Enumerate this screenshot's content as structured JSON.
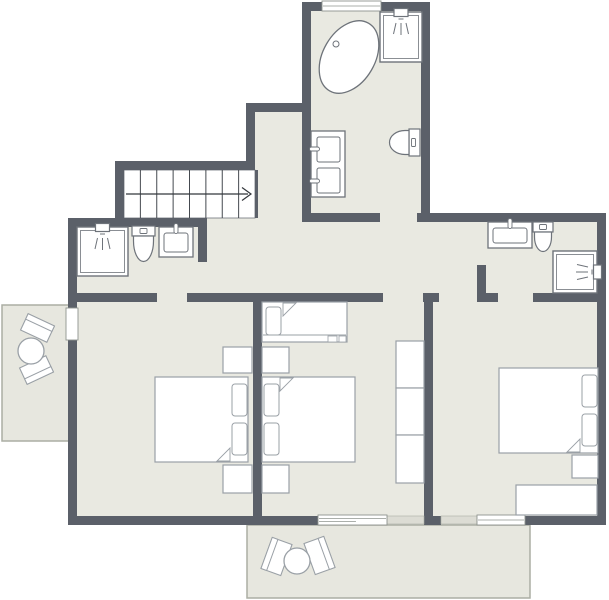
{
  "meta": {
    "description": "Architectural floor plan of an upper storey: three bedrooms, three bathrooms, staircase with up-arrow, two balconies with round tables and chairs. No text labels are rendered in the image."
  },
  "canvas": {
    "width": 609,
    "height": 600
  },
  "colors": {
    "wall": "#5b6069",
    "wall_light": "#dcdcd4",
    "floor": "#e9e9e1",
    "stairs_floor": "#ffffff",
    "balcony_floor": "#e7e7df",
    "balcony_border": "#abaea4",
    "fixture_stroke": "#6e737a",
    "furniture_stroke": "#9aa0a6",
    "opening_stroke": "#8f948f",
    "stair_line": "#44494f",
    "arrow": "#33373c",
    "white": "#ffffff"
  },
  "floorplan": {
    "floors": [
      {
        "name": "floor-top-bathroom",
        "rect": [
          306,
          8,
          120,
          210
        ]
      },
      {
        "name": "floor-upper-hall",
        "rect": [
          250,
          107,
          56,
          115
        ]
      },
      {
        "name": "floor-main-level",
        "rect": [
          72,
          218,
          530,
          303
        ]
      }
    ],
    "balconies": [
      {
        "name": "balcony-left",
        "rect": [
          2,
          305,
          70,
          136
        ]
      },
      {
        "name": "balcony-bottom",
        "rect": [
          247,
          525,
          283,
          73
        ]
      }
    ],
    "stairs": {
      "name": "staircase",
      "rect": [
        124,
        170,
        131,
        48
      ],
      "steps": 8,
      "rail_y": 194,
      "arrow": "right"
    },
    "walls": [
      {
        "name": "wall-topbath-left",
        "r": [
          302,
          2,
          9,
          220
        ]
      },
      {
        "name": "wall-topbath-top-a",
        "r": [
          302,
          2,
          20,
          9
        ]
      },
      {
        "name": "wall-topbath-top-b",
        "r": [
          381,
          2,
          49,
          9
        ]
      },
      {
        "name": "wall-topbath-right",
        "r": [
          421,
          2,
          9,
          220
        ]
      },
      {
        "name": "wall-step-horizontal",
        "r": [
          246,
          103,
          65,
          9
        ]
      },
      {
        "name": "wall-step-vertical",
        "r": [
          246,
          103,
          9,
          67
        ]
      },
      {
        "name": "wall-stairs-top",
        "r": [
          115,
          161,
          140,
          9
        ]
      },
      {
        "name": "wall-stairs-left",
        "r": [
          115,
          161,
          9,
          66
        ]
      },
      {
        "name": "wall-west-top",
        "r": [
          68,
          218,
          139,
          9
        ]
      },
      {
        "name": "wall-west-upper",
        "r": [
          68,
          218,
          9,
          90
        ]
      },
      {
        "name": "wall-west-lower",
        "r": [
          68,
          340,
          9,
          185
        ]
      },
      {
        "name": "wall-topbath-bottom-a",
        "r": [
          302,
          213,
          78,
          9
        ]
      },
      {
        "name": "wall-topbath-bottom-b",
        "r": [
          417,
          213,
          13,
          9
        ]
      },
      {
        "name": "wall-north-right",
        "r": [
          430,
          213,
          176,
          9
        ]
      },
      {
        "name": "wall-east",
        "r": [
          597,
          213,
          9,
          312
        ]
      },
      {
        "name": "wall-rightbath-left",
        "r": [
          477,
          265,
          9,
          37
        ]
      },
      {
        "name": "wall-rightbath-bottom-a",
        "r": [
          477,
          293,
          21,
          9
        ]
      },
      {
        "name": "wall-rightbath-bottom-b",
        "r": [
          533,
          293,
          64,
          9
        ]
      },
      {
        "name": "wall-mid-a",
        "r": [
          68,
          293,
          89,
          9
        ]
      },
      {
        "name": "wall-mid-b",
        "r": [
          187,
          293,
          196,
          9
        ]
      },
      {
        "name": "wall-mid-c",
        "r": [
          423,
          293,
          16,
          9
        ]
      },
      {
        "name": "wall-leftbath-right",
        "r": [
          198,
          218,
          9,
          44
        ]
      },
      {
        "name": "wall-bedroom1-2",
        "r": [
          253,
          302,
          9,
          214
        ]
      },
      {
        "name": "wall-bedroom2-3",
        "r": [
          424,
          302,
          9,
          214
        ]
      },
      {
        "name": "wall-south-a",
        "r": [
          68,
          516,
          250,
          9
        ]
      },
      {
        "name": "wall-south-b",
        "r": [
          424,
          516,
          17,
          9
        ]
      },
      {
        "name": "wall-south-c",
        "r": [
          525,
          516,
          81,
          9
        ]
      },
      {
        "name": "wall-stair-divider",
        "r": [
          255,
          170,
          3,
          48
        ]
      }
    ],
    "low_walls": [
      {
        "name": "low-wall-a",
        "r": [
          387,
          516,
          37,
          8
        ]
      },
      {
        "name": "low-wall-b",
        "r": [
          441,
          516,
          36,
          8
        ]
      }
    ],
    "openings": [
      {
        "name": "window-top",
        "style": "window",
        "rect": [
          322,
          1,
          59,
          10
        ]
      },
      {
        "name": "balcony-door-left",
        "style": "door",
        "rect": [
          66,
          308,
          12,
          32
        ]
      },
      {
        "name": "sliding-door-bottom",
        "style": "slider",
        "rect": [
          318,
          515,
          69,
          10
        ]
      },
      {
        "name": "window-bottom",
        "style": "window",
        "rect": [
          477,
          515,
          48,
          10
        ]
      }
    ],
    "fixtures": [
      {
        "type": "bathtub",
        "name": "bathtub",
        "cx": 349,
        "cy": 57,
        "rx": 39,
        "ry": 26,
        "rot": -60,
        "drain": [
          336,
          44
        ]
      },
      {
        "type": "shower",
        "name": "shower-top-bathroom",
        "rect": [
          380,
          12,
          42,
          50
        ],
        "head": "top"
      },
      {
        "type": "vanity2",
        "name": "double-sink-vanity",
        "rect": [
          311,
          131,
          34,
          66
        ]
      },
      {
        "type": "toilet",
        "name": "toilet-top-bathroom",
        "dir": "left",
        "rect": [
          388,
          129,
          32,
          27
        ]
      },
      {
        "type": "shower",
        "name": "shower-left-bathroom",
        "rect": [
          77,
          227,
          51,
          49
        ],
        "head": "top"
      },
      {
        "type": "toilet",
        "name": "toilet-left-bathroom",
        "dir": "down",
        "rect": [
          132,
          226,
          23,
          37
        ]
      },
      {
        "type": "sink",
        "name": "sink-left-bathroom",
        "rect": [
          159,
          227,
          34,
          30
        ]
      },
      {
        "type": "sink",
        "name": "sink-right-bathroom",
        "rect": [
          488,
          222,
          44,
          26
        ]
      },
      {
        "type": "toilet",
        "name": "toilet-right-bathroom",
        "dir": "down",
        "rect": [
          533,
          222,
          20,
          31
        ]
      },
      {
        "type": "shower",
        "name": "shower-right-bathroom",
        "rect": [
          553,
          251,
          44,
          42
        ],
        "head": "right"
      }
    ],
    "furniture": [
      {
        "type": "bed",
        "name": "double-bed-left-bedroom",
        "rect": [
          155,
          377,
          93,
          85
        ],
        "pillows": "right"
      },
      {
        "type": "rect",
        "name": "nightstand",
        "rect": [
          223,
          347,
          29,
          26
        ]
      },
      {
        "type": "rect",
        "name": "nightstand",
        "rect": [
          223,
          465,
          29,
          28
        ]
      },
      {
        "type": "bed",
        "name": "double-bed-middle-room",
        "rect": [
          262,
          377,
          93,
          85
        ],
        "pillows": "left"
      },
      {
        "type": "rect",
        "name": "nightstand",
        "rect": [
          262,
          347,
          27,
          26
        ]
      },
      {
        "type": "rect",
        "name": "nightstand",
        "rect": [
          262,
          465,
          27,
          28
        ]
      },
      {
        "type": "bed-single",
        "name": "single-bed",
        "rect": [
          262,
          302,
          85,
          40
        ]
      },
      {
        "type": "rect",
        "name": "wardrobe-section",
        "rect": [
          396,
          341,
          28,
          47
        ]
      },
      {
        "type": "rect",
        "name": "wardrobe-section",
        "rect": [
          396,
          388,
          28,
          47
        ]
      },
      {
        "type": "rect",
        "name": "wardrobe-section",
        "rect": [
          396,
          435,
          28,
          48
        ]
      },
      {
        "type": "bed",
        "name": "double-bed-right-bedroom",
        "rect": [
          499,
          368,
          99,
          85
        ],
        "pillows": "right"
      },
      {
        "type": "rect",
        "name": "nightstand",
        "rect": [
          572,
          455,
          26,
          23
        ]
      },
      {
        "type": "rect",
        "name": "bench",
        "rect": [
          516,
          485,
          81,
          30
        ]
      },
      {
        "type": "chair",
        "name": "chair",
        "rect": [
          23,
          319,
          29,
          18
        ],
        "rot": 25,
        "back": "top"
      },
      {
        "type": "chair",
        "name": "chair",
        "rect": [
          22,
          361,
          29,
          18
        ],
        "rot": -25,
        "back": "bottom"
      },
      {
        "type": "table",
        "name": "round-table",
        "cx": 31,
        "cy": 351,
        "r": 13
      },
      {
        "type": "chair",
        "name": "chair",
        "rect": [
          266,
          540,
          21,
          33
        ],
        "rot": 20,
        "back": "left"
      },
      {
        "type": "chair",
        "name": "chair",
        "rect": [
          309,
          539,
          21,
          33
        ],
        "rot": -20,
        "back": "right"
      },
      {
        "type": "table",
        "name": "round-table",
        "cx": 297,
        "cy": 561,
        "r": 13
      }
    ]
  }
}
